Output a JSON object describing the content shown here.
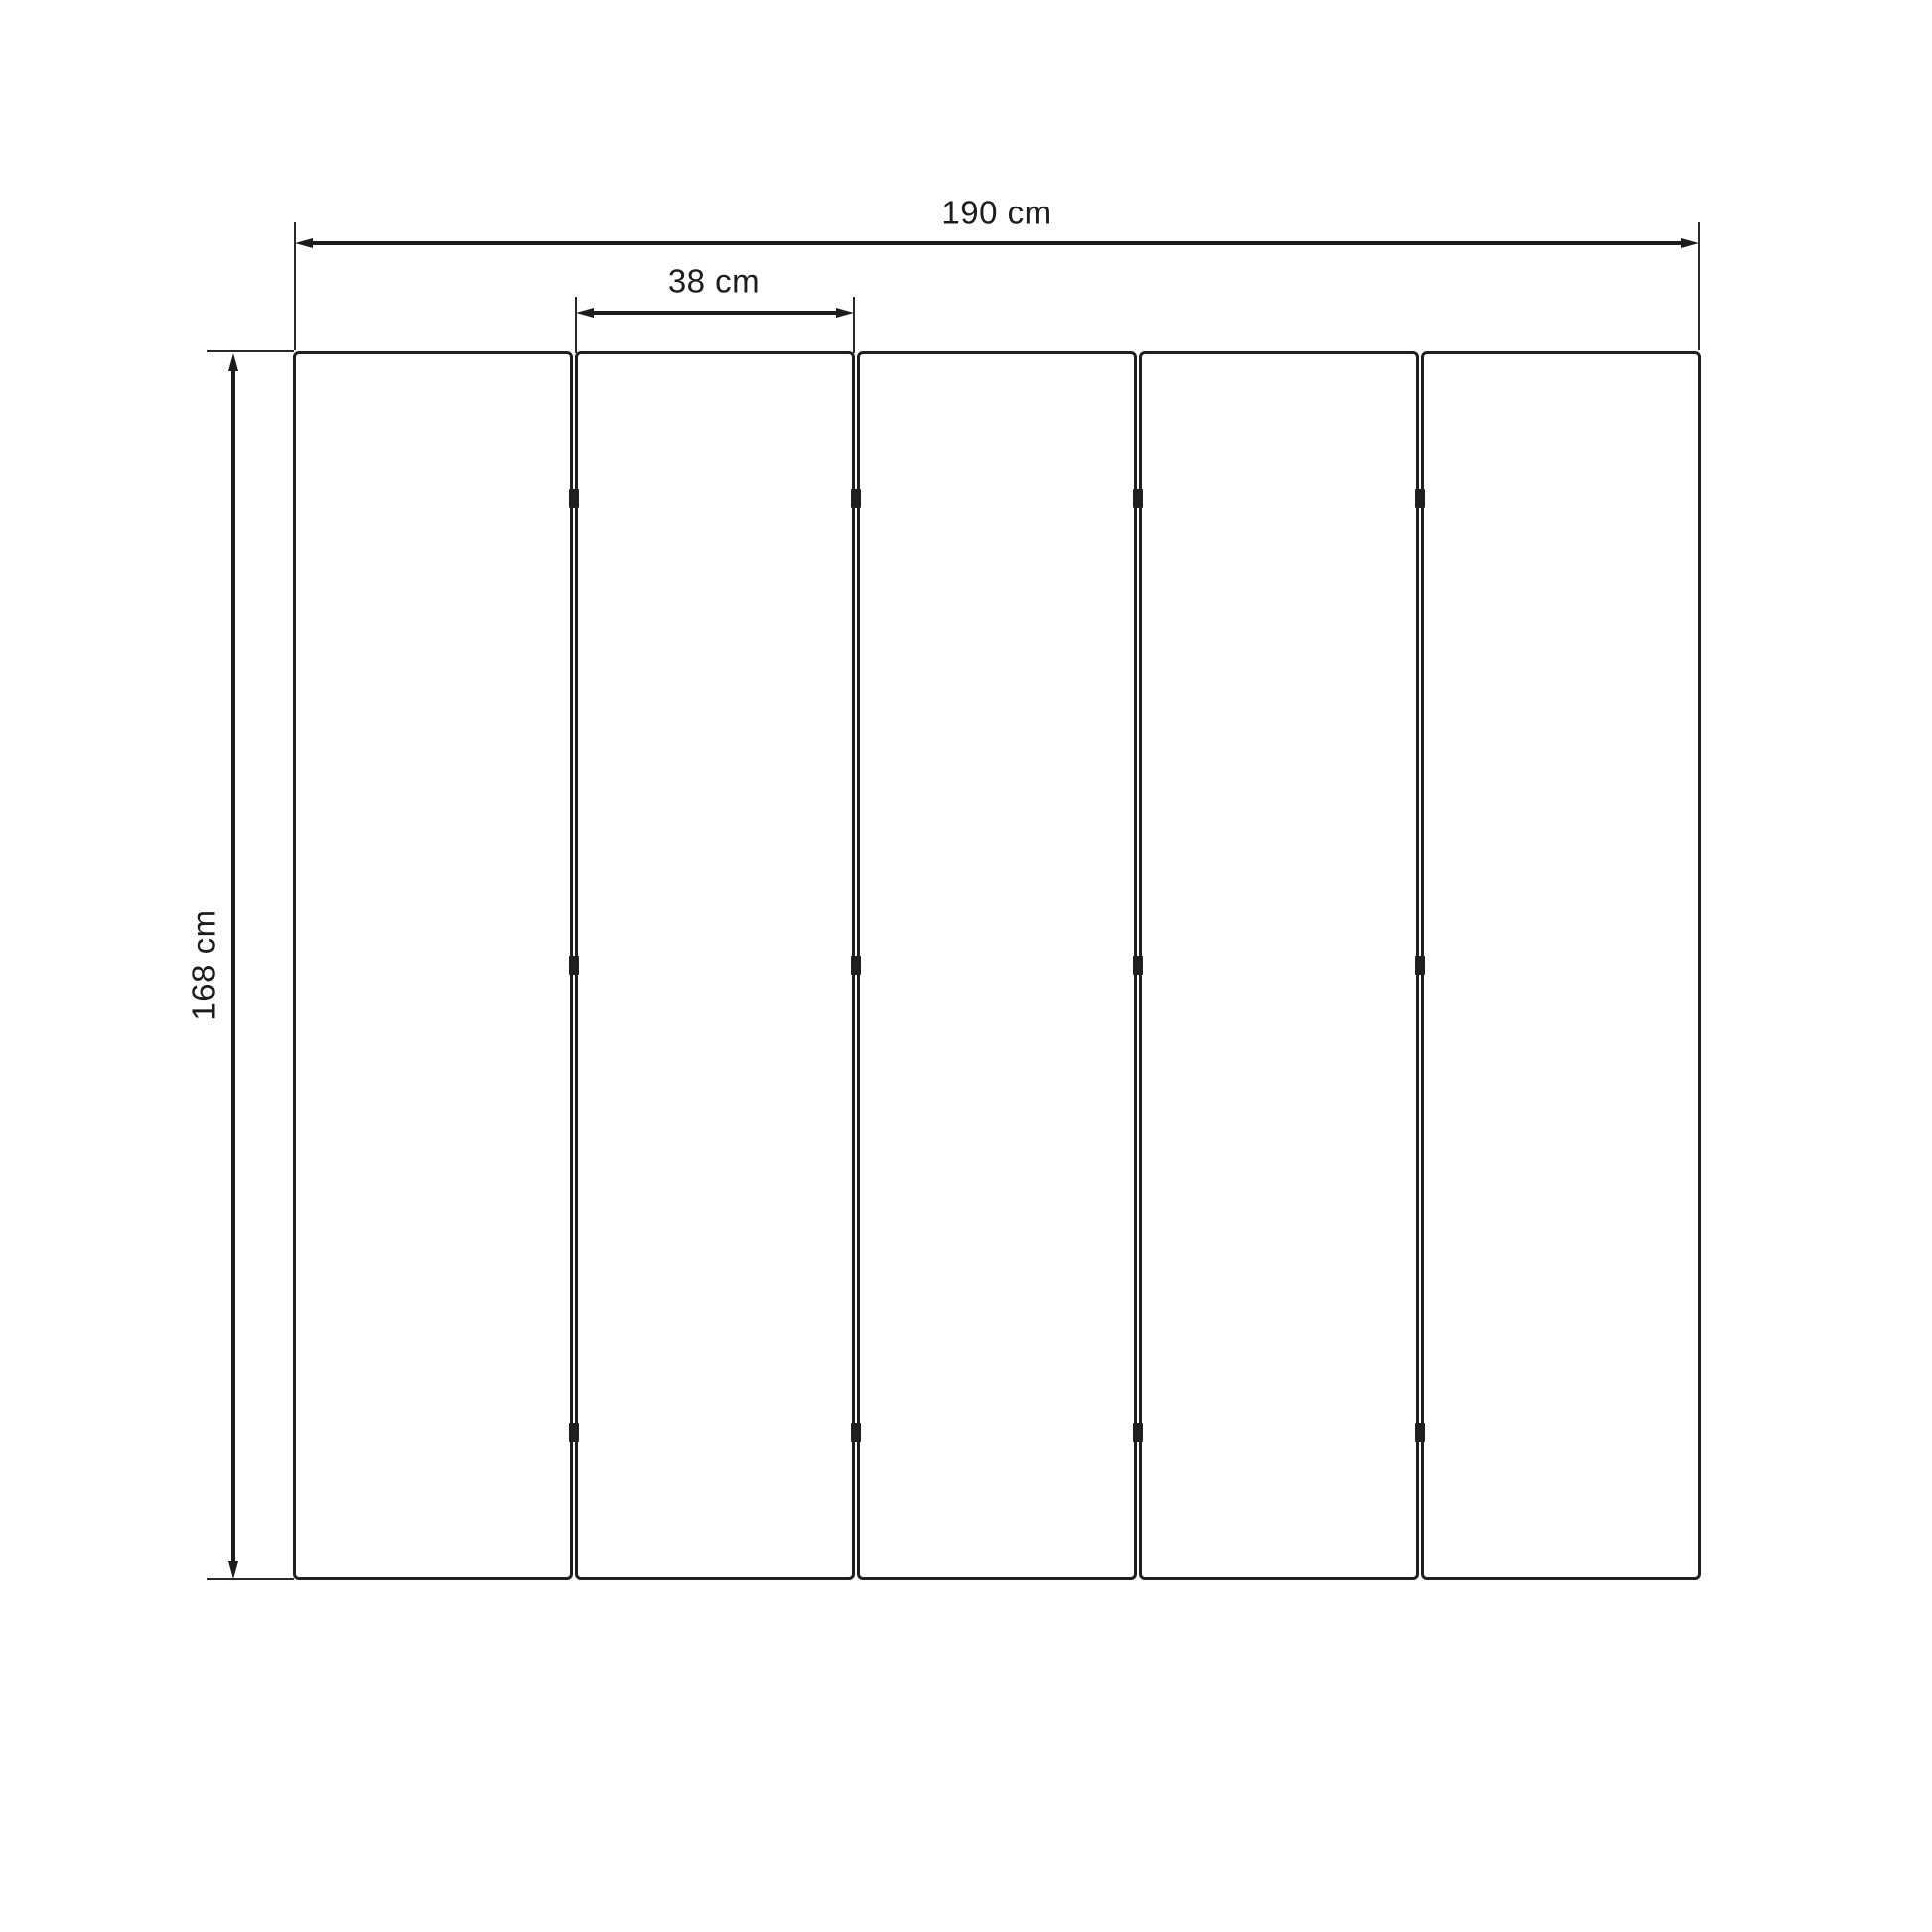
{
  "drawing": {
    "type": "dimensioned-technical-drawing",
    "unit": "cm",
    "panel_count": 5,
    "hinge_marks_per_gap": 3,
    "dimensions": {
      "total_width": {
        "value": 190,
        "label": "190 cm"
      },
      "panel_width": {
        "value": 38,
        "label": "38 cm"
      },
      "height": {
        "value": 168,
        "label": "168 cm"
      }
    },
    "colors": {
      "line": "#1c1c1c",
      "panel_border": "#1f1f1f",
      "background": "#ffffff"
    }
  }
}
